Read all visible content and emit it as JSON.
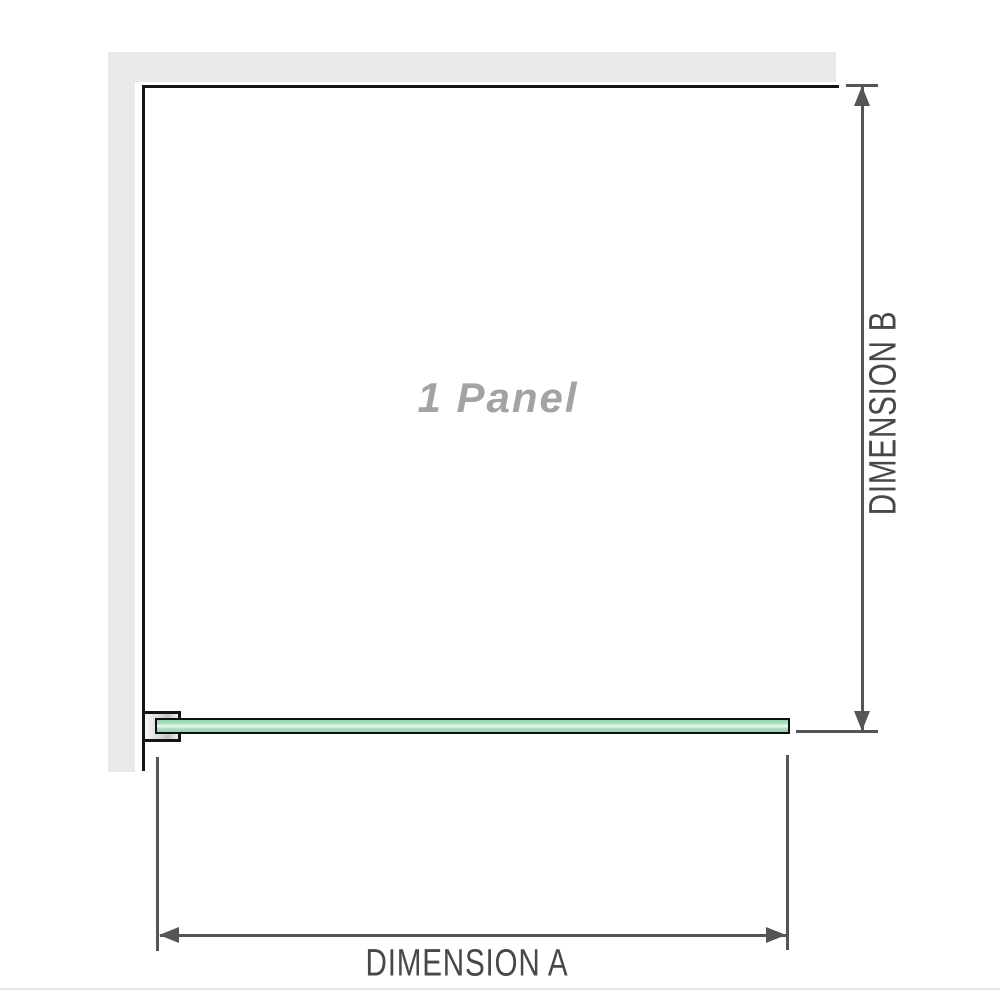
{
  "diagram": {
    "panel_label": "1 Panel",
    "dimension_a_label": "DIMENSION A",
    "dimension_b_label": "DIMENSION B",
    "colors": {
      "wall": "#e9e9e9",
      "outline": "#141414",
      "dimension": "#555558",
      "dimension_text": "#47474c",
      "panel_text": "#a3a3a3",
      "glass_fill": "#abdfc4",
      "glass_border": "#101010",
      "baseline": "#e4e4e8"
    }
  }
}
